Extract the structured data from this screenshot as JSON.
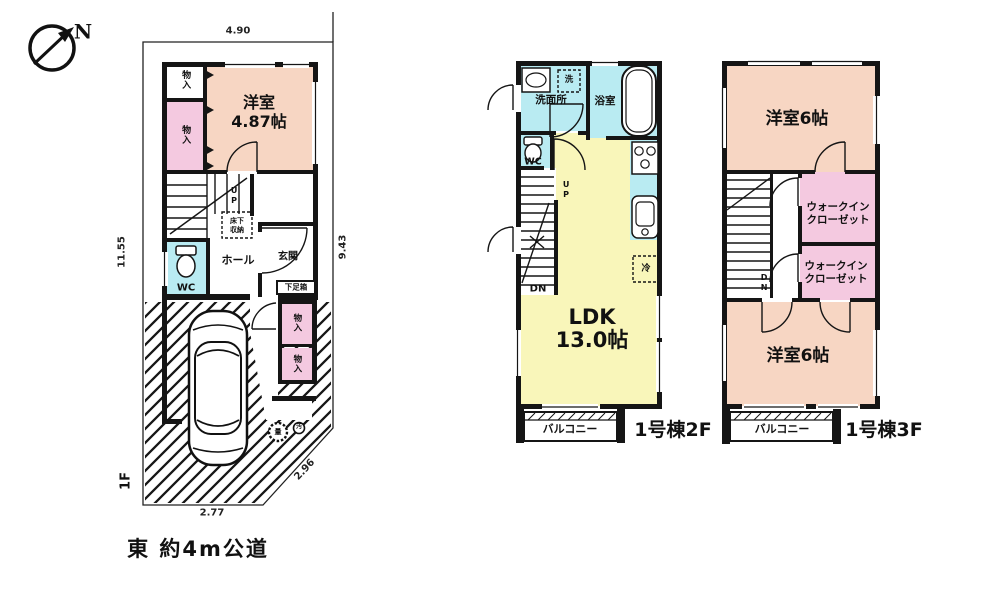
{
  "compass": {
    "north": "N"
  },
  "road_note": "東 約4m公道",
  "colors": {
    "room_salmon": "#f7d6c3",
    "closet_pink": "#f4c9e0",
    "water_cyan": "#b9ebf2",
    "ldk_yellow": "#f9f6ba",
    "wall": "#151515"
  },
  "f1": {
    "floor_label": "1F",
    "dim_top": "4.90",
    "dim_right": "9.43",
    "dim_left": "11.55",
    "dim_bottom": "2.77",
    "dim_diag": "2.96",
    "closet1": "物入",
    "closet2": "物入",
    "room": "洋室",
    "room_size": "4.87帖",
    "up": "UP",
    "underfloor1": "床下",
    "underfloor2": "収納",
    "hall": "ホール",
    "entrance": "玄関",
    "wc": "WC",
    "shoebox": "下足箱",
    "closet3": "物入",
    "closet4": "物入",
    "meter1": "量",
    "meter2": "汚"
  },
  "f2": {
    "name": "1号棟2F",
    "washroom": "洗面所",
    "wash_symbol": "洗",
    "bath": "浴室",
    "wc": "WC",
    "up": "UP",
    "dn": "DN",
    "ldk": "LDK",
    "ldk_size": "13.0帖",
    "fridge": "冷",
    "balcony": "バルコニー"
  },
  "f3": {
    "name": "1号棟3F",
    "room_top": "洋室6帖",
    "wic1a": "ウォークイン",
    "wic1b": "クローゼット",
    "wic2a": "ウォークイン",
    "wic2b": "クローゼット",
    "dn": "DN",
    "room_bottom": "洋室6帖",
    "balcony": "バルコニー"
  }
}
